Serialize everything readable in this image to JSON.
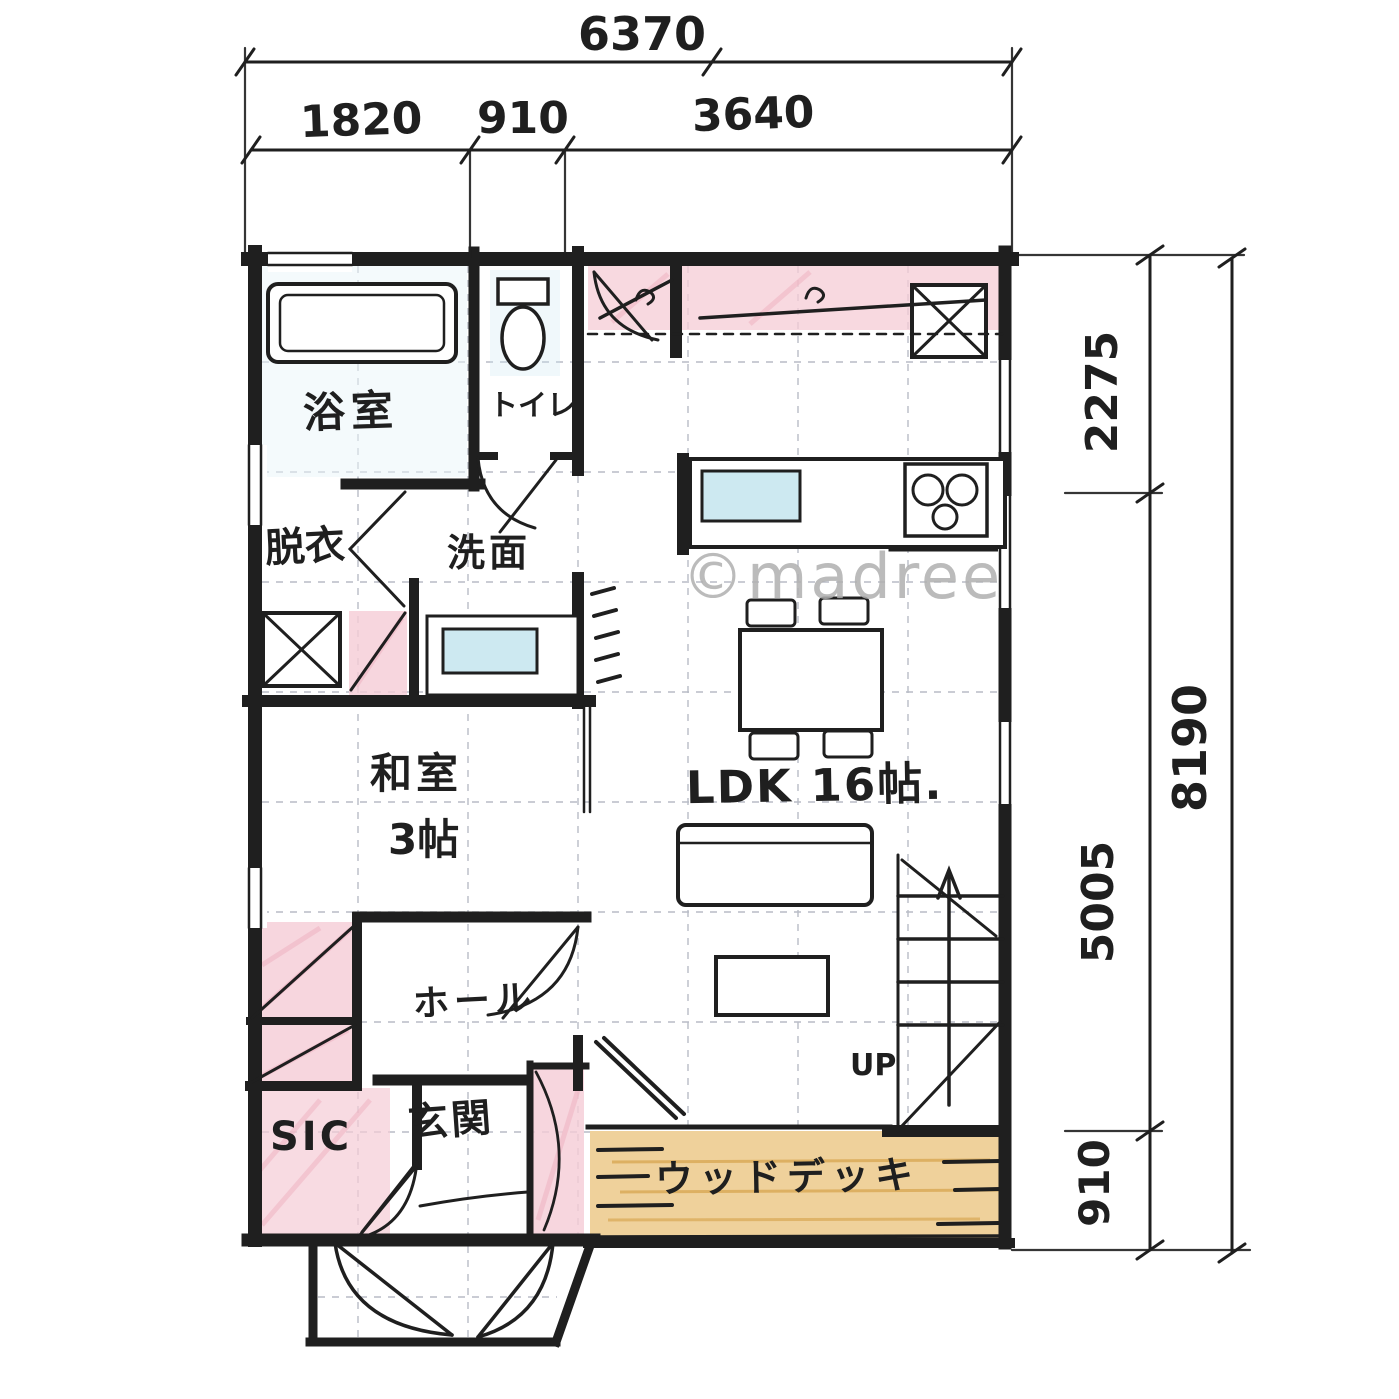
{
  "watermark": "©madree",
  "dimensions": {
    "top_total": "6370",
    "top_segments": [
      "1820",
      "910",
      "3640"
    ],
    "right_total": "8190",
    "right_segments": [
      "2275",
      "5005",
      "910"
    ]
  },
  "rooms": {
    "bath": "浴室",
    "toilet": "トイレ",
    "dressing": "脱衣",
    "washroom": "洗面",
    "japanese_room": "和室",
    "japanese_room_size": "3帖",
    "ldk": "LDK 16帖.",
    "hall": "ホール",
    "shoe_closet": "SIC",
    "entrance": "玄関",
    "wood_deck": "ウッドデッキ",
    "stairs_up": "UP"
  },
  "colors": {
    "ink": "#1f1f1f",
    "pink": "#f5ccd6",
    "blue": "#cde9f1",
    "tan": "#efd19b",
    "grid": "#b8bcc6",
    "watermark": "#b0b0b0"
  }
}
